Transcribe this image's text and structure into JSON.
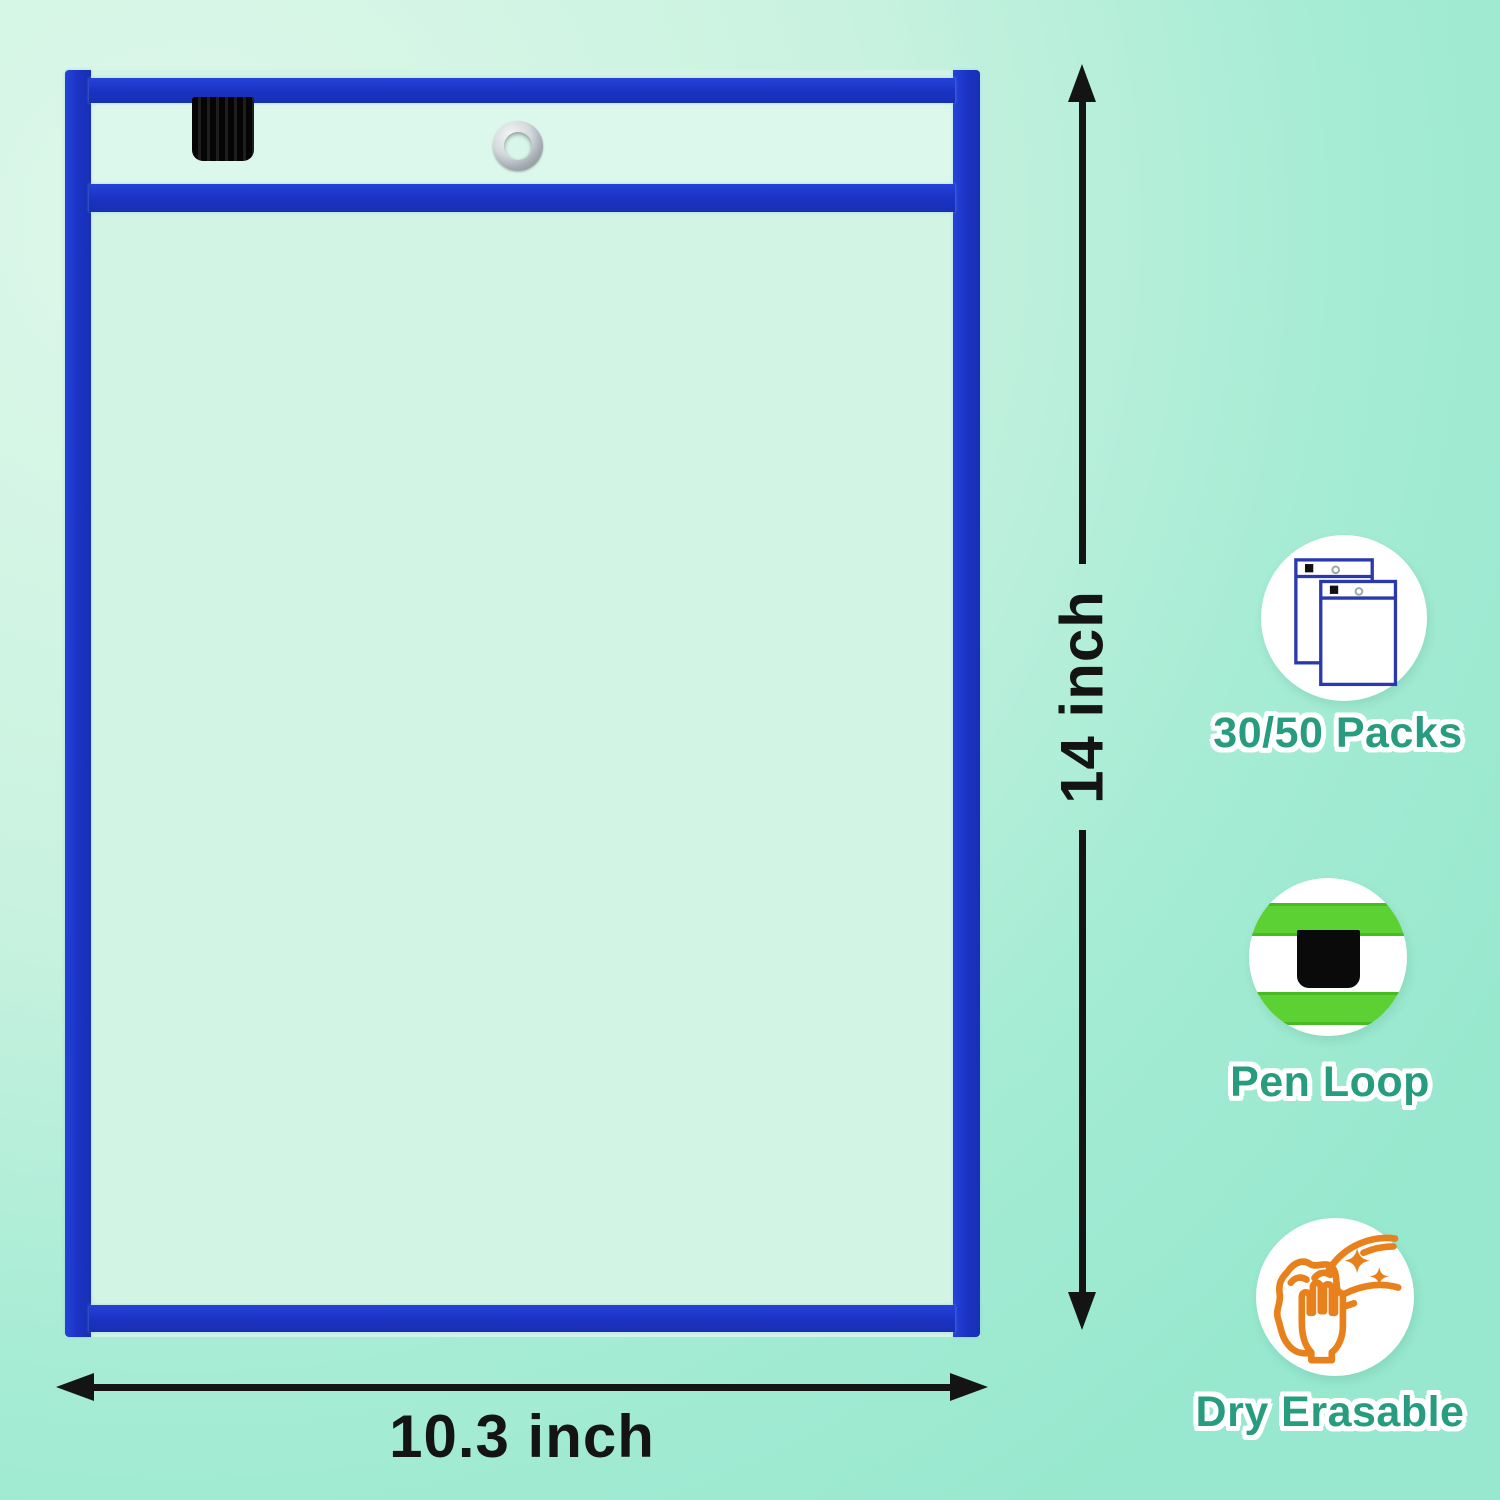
{
  "product": {
    "name": "dry-erase-pocket-diagram",
    "dimensions": {
      "height_label": "14 inch",
      "width_label": "10.3 inch"
    },
    "pocket_parts": {
      "pen_loop": "pen-loop-tab",
      "grommet": "metal-grommet-eyelet"
    }
  },
  "features": [
    {
      "icon": "pockets-stack-icon",
      "label": "30/50 Packs"
    },
    {
      "icon": "pen-loop-icon",
      "label": "Pen Loop"
    },
    {
      "icon": "dry-erase-wipe-icon",
      "label": "Dry Erasable"
    }
  ],
  "colors": {
    "background_light": "#def8ea",
    "background_dark": "#97e8ce",
    "pocket_border_blue": "#1b32c2",
    "pocket_fill": "#d2f4e4",
    "pen_loop_black": "#0a0a0a",
    "grommet_silver": "#c4cbd0",
    "dimension_black": "#141414",
    "label_teal": "#279c7e",
    "icon_green": "#5bd133",
    "icon_navy": "#2a3aad",
    "icon_orange": "#e8811c"
  }
}
